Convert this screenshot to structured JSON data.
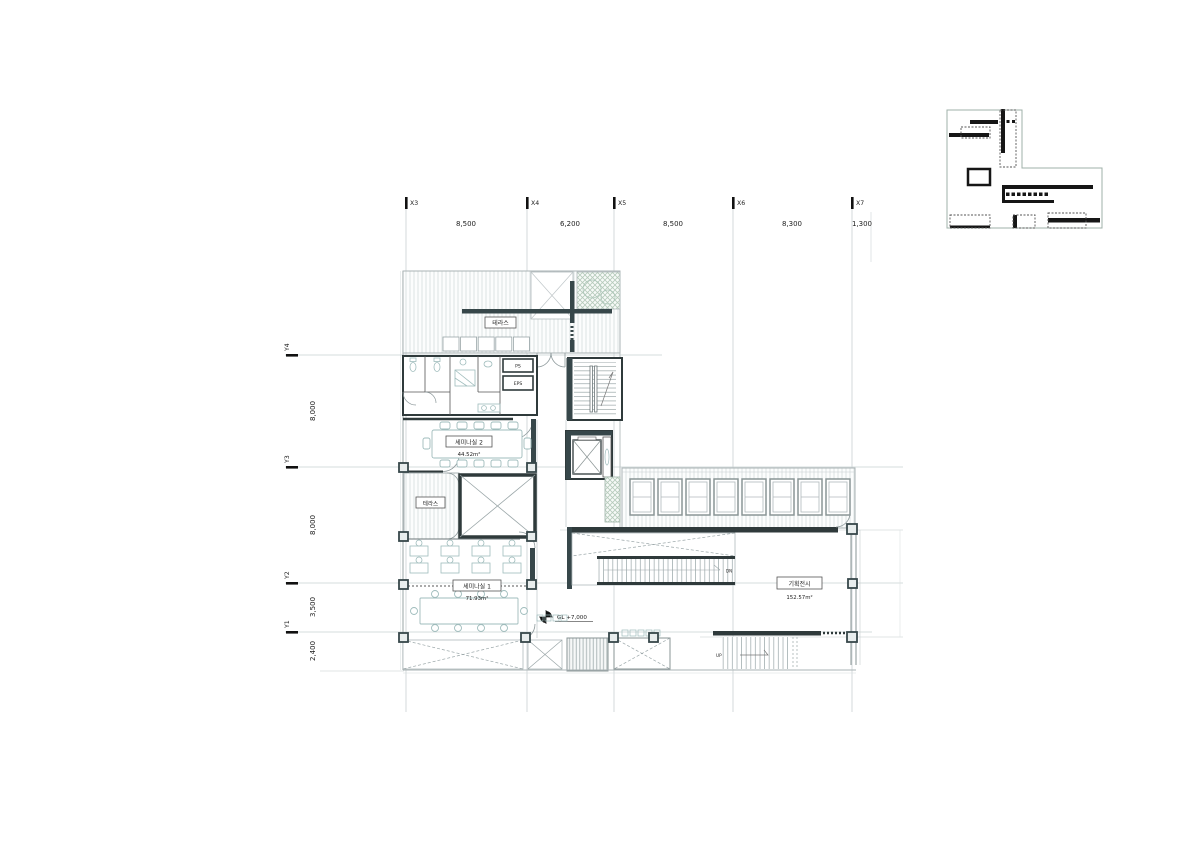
{
  "sheet": {
    "kind": "architectural floor plan",
    "background": "#ffffff"
  },
  "grid": {
    "x_axes": [
      {
        "label": "X3"
      },
      {
        "label": "X4"
      },
      {
        "label": "X5"
      },
      {
        "label": "X6"
      },
      {
        "label": "X7"
      }
    ],
    "x_dims": [
      "8,500",
      "6,200",
      "8,500",
      "8,300",
      "1,300"
    ],
    "y_axes": [
      {
        "label": "Y4"
      },
      {
        "label": "Y3"
      },
      {
        "label": "Y2"
      },
      {
        "label": "Y1"
      }
    ],
    "y_dims": [
      "8,000",
      "8,000",
      "3,500",
      "2,400"
    ]
  },
  "rooms": {
    "terrace_top": {
      "label": "테라스"
    },
    "terrace_left": {
      "label": "테라스"
    },
    "seminar2": {
      "label": "세미나실 2",
      "area": "44.52m²"
    },
    "seminar1": {
      "label": "세미나실 1",
      "area": "71.93m²"
    },
    "exhibition": {
      "label": "기획전시",
      "area": "152.57m²"
    }
  },
  "shafts": {
    "ps": "PS",
    "eps": "EPS"
  },
  "annotations": {
    "level": "GL +7,000",
    "stair_up": "UP",
    "stair_dn": "DN"
  },
  "colors": {
    "wall_dark": "#37474a",
    "wall_black": "#2f3a3b",
    "line_light": "#aab3b5",
    "furniture": "#9fbcbc",
    "grid_line": "#c9d0d2"
  }
}
